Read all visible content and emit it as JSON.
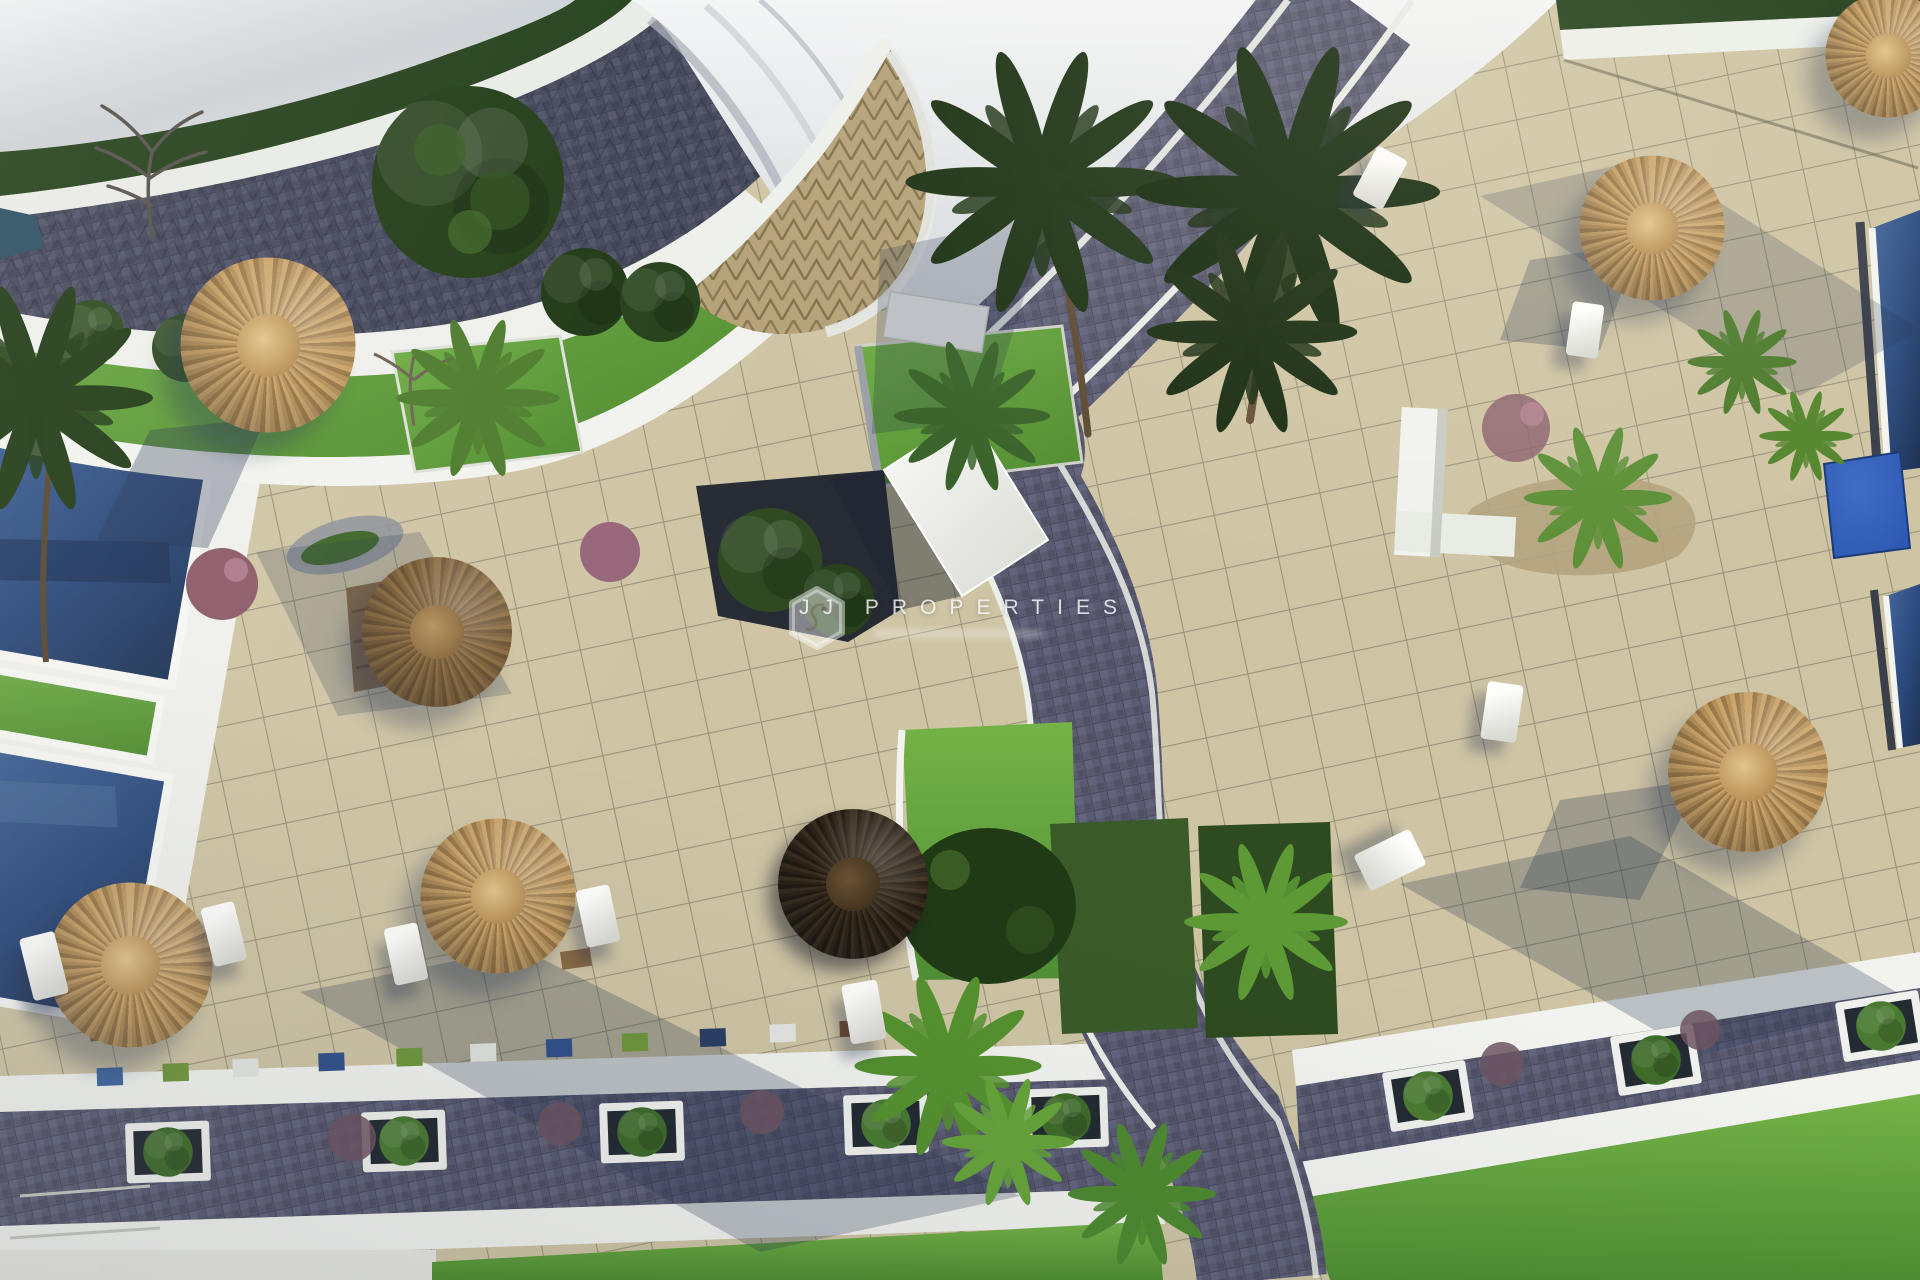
{
  "scene": {
    "title": "Aerial 3D architectural render - resort pool courtyard",
    "type": "architectural-visualization",
    "view": "top-down bird's-eye",
    "lighting": "sunny daytime, long shadows cast toward lower-left",
    "features": {
      "swimming_pools": 4,
      "straw_parasols": 8,
      "sun_loungers": 9,
      "palm_trees": 12,
      "planter_boxes": 8,
      "terrace": "beige square-tiled sun terraces",
      "walkways": "violet-grey cobbled promenade crossing diagonally",
      "lawns": "bright green lawns along the bottom edge",
      "roof": "white curved building roof with triangle-patterned plaza at top centre"
    }
  },
  "watermark": {
    "brand": "JJ PROPERTIES",
    "logo": "shield-monogram",
    "subline": "blurred illegible small print"
  },
  "palette": {
    "tile_beige": "#cfc5a5",
    "tile_grid": "#8d8871",
    "cobble": "#5a5b71",
    "cobble_light": "#666882",
    "cobble_dark": "#474a5e",
    "pool_water": "#2b4a7d",
    "pool_deep": "#1e3253",
    "water_cube": "#2b55b0",
    "lawn": "#5f9c38",
    "grass": "#569032",
    "foliage_dark": "#24401a",
    "foliage_mid": "#39632a",
    "foliage_light": "#5d9a36",
    "hedge": "#24401c",
    "straw": "#c9a268",
    "straw_mid": "#9a7847",
    "straw_dark": "#8a6c42",
    "straw_shaded": "#2d2418",
    "wall_white": "#f2f3ef",
    "roof_white": "#e9ebed",
    "plaza_tan": "#b5a279",
    "accent_blue": "#3f66a0",
    "accent_green": "#6f963c",
    "shadow": "rgba(36,50,78,0.33)"
  }
}
